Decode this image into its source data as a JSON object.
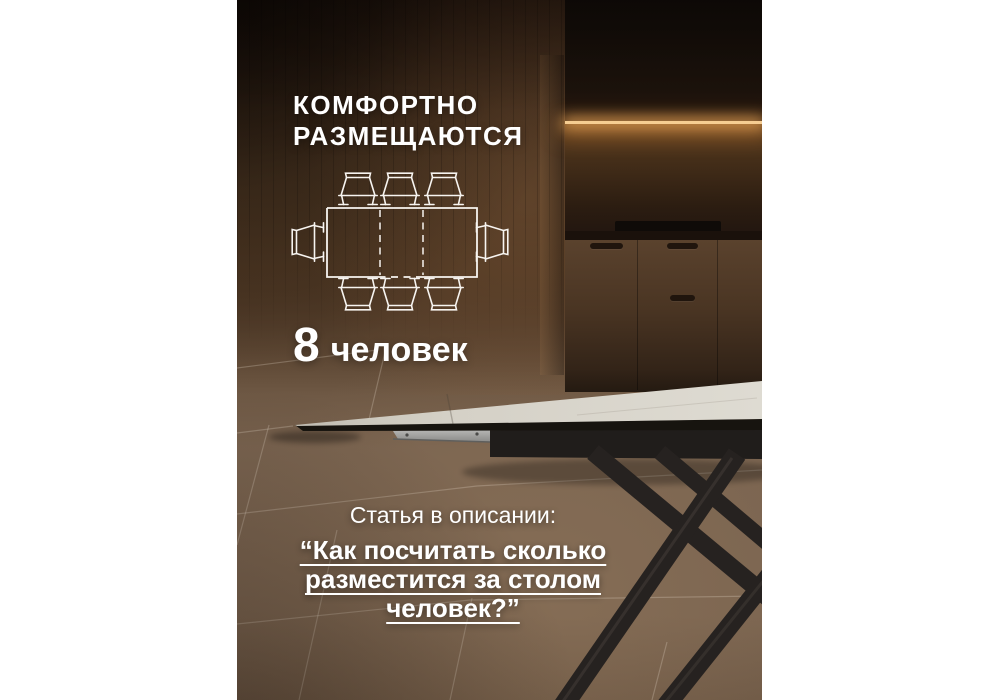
{
  "poster": {
    "header": {
      "line1": "КОМФОРТНО",
      "line2": "РАЗМЕЩАЮТСЯ"
    },
    "capacity": {
      "number": "8",
      "label": "человек"
    },
    "footer": {
      "intro": "Статья в описании:",
      "quote_lines": [
        "“Как посчитать сколько",
        "разместится за столом",
        "человек?”"
      ]
    },
    "diagram": {
      "description": "extendable dining table top view with chairs",
      "seats_top": 3,
      "seats_bottom": 3,
      "seats_left": 1,
      "seats_right": 1,
      "total_seats": 8
    },
    "colors": {
      "text": "#ffffff",
      "wall_brown": "#46301f",
      "floor_brown": "#7a6450",
      "led_glow": "#f6cd92",
      "tabletop_gray": "#d8d4ca",
      "frame_black": "#201d1b",
      "margin_background": "#ffffff"
    }
  }
}
